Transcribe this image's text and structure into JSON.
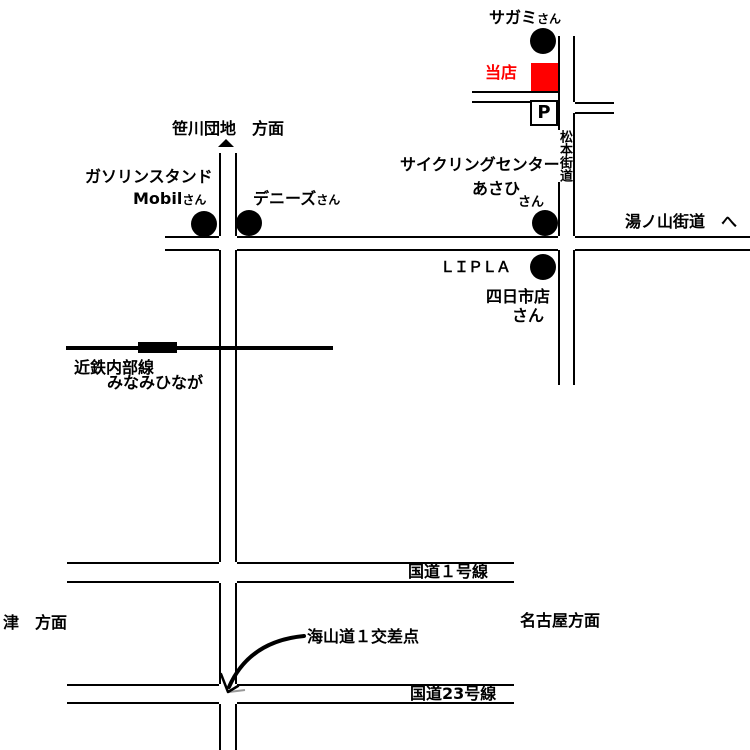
{
  "map_title": "store access map",
  "colors": {
    "road": "#000000",
    "store_red": "#FF0000",
    "background": "#FFFFFF"
  },
  "labels": {
    "sagami_name": "サガミ",
    "sagami_suffix": "さん",
    "our_store": "当店",
    "parking": "P",
    "matsumoto_kaido": "松本街道",
    "sasagawa_danchi_direction": "笹川団地　方面",
    "gas_station": "ガソリンスタンド",
    "mobil_name": "Mobil",
    "mobil_suffix": "さん",
    "dennys_name": "デニーズ",
    "dennys_suffix": "さん",
    "cycling_center": "サイクリングセンター",
    "asahi": "あさひ",
    "asahi_suffix": "さん",
    "yunoyama_kaido": "湯ノ山街道　へ",
    "lipla": "ＬＩＰＬＡ",
    "lipla_branch": "四日市店",
    "lipla_suffix": "さん",
    "kintetsu_line": "近鉄内部線",
    "minamihinaga_station": "みなみひなが",
    "route1": "国道１号線",
    "tsu_direction": "津　方面",
    "nagoya_direction": "名古屋方面",
    "kaisando_intersection": "海山道１交差点",
    "route23": "国道23号線"
  }
}
